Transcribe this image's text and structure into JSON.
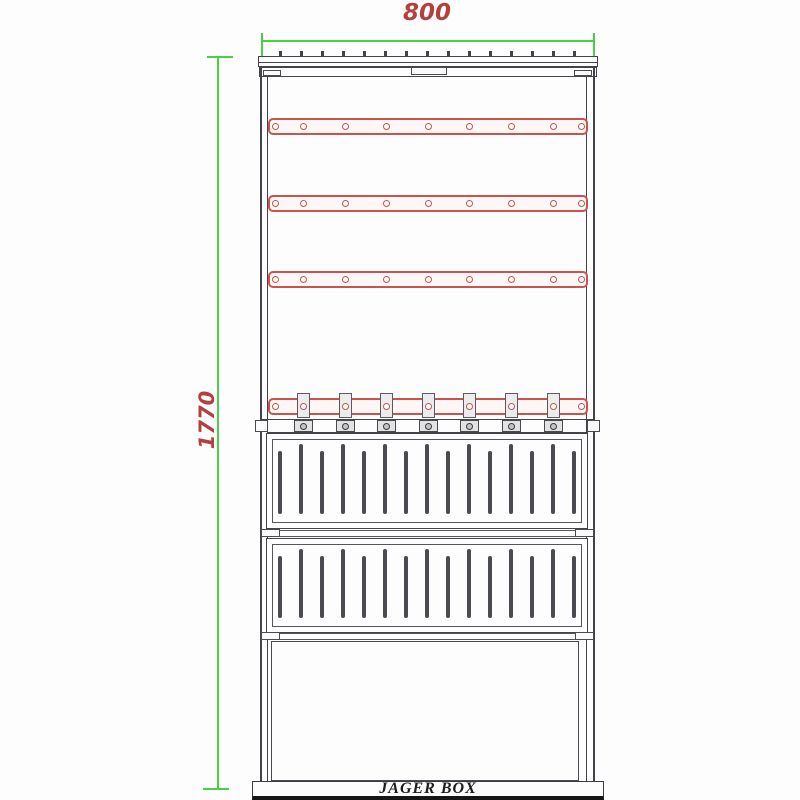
{
  "labels": {
    "width_dim": "800",
    "height_dim": "1770",
    "nameplate": "JAGER BOX"
  },
  "colors": {
    "dimension_line": "#45d045",
    "dimension_text": "#b4403d",
    "rail_red": "#c9534f",
    "outline_dark": "#43434a",
    "background": "#fdfdfd"
  },
  "counts": {
    "mounting_rails": 4,
    "holes_per_rail": 9,
    "cable_clamps": 7,
    "louver_panels": 2,
    "slots_per_panel": 15,
    "roof_ticks": 15
  },
  "geometry": {
    "dim_top": {
      "x1": 262,
      "x2": 594,
      "y": 41
    },
    "dim_left": {
      "x": 218,
      "y1": 57,
      "y2": 790
    },
    "rail_x1": 268,
    "rail_w": 320,
    "rail_h": 17,
    "rail_y": [
      118,
      195,
      271,
      398
    ],
    "hole_x": [
      275,
      303,
      345,
      386,
      428,
      469,
      511,
      553,
      581
    ],
    "clamp_x": [
      303,
      345,
      386,
      428,
      469,
      511,
      553
    ],
    "slot_x": [
      280,
      301,
      322,
      343,
      364,
      385,
      406,
      427,
      448,
      469,
      490,
      511,
      532,
      553,
      574
    ],
    "panels": [
      {
        "slot_top": 444,
        "slot_bottom": 514
      },
      {
        "slot_top": 549,
        "slot_bottom": 618
      }
    ]
  }
}
